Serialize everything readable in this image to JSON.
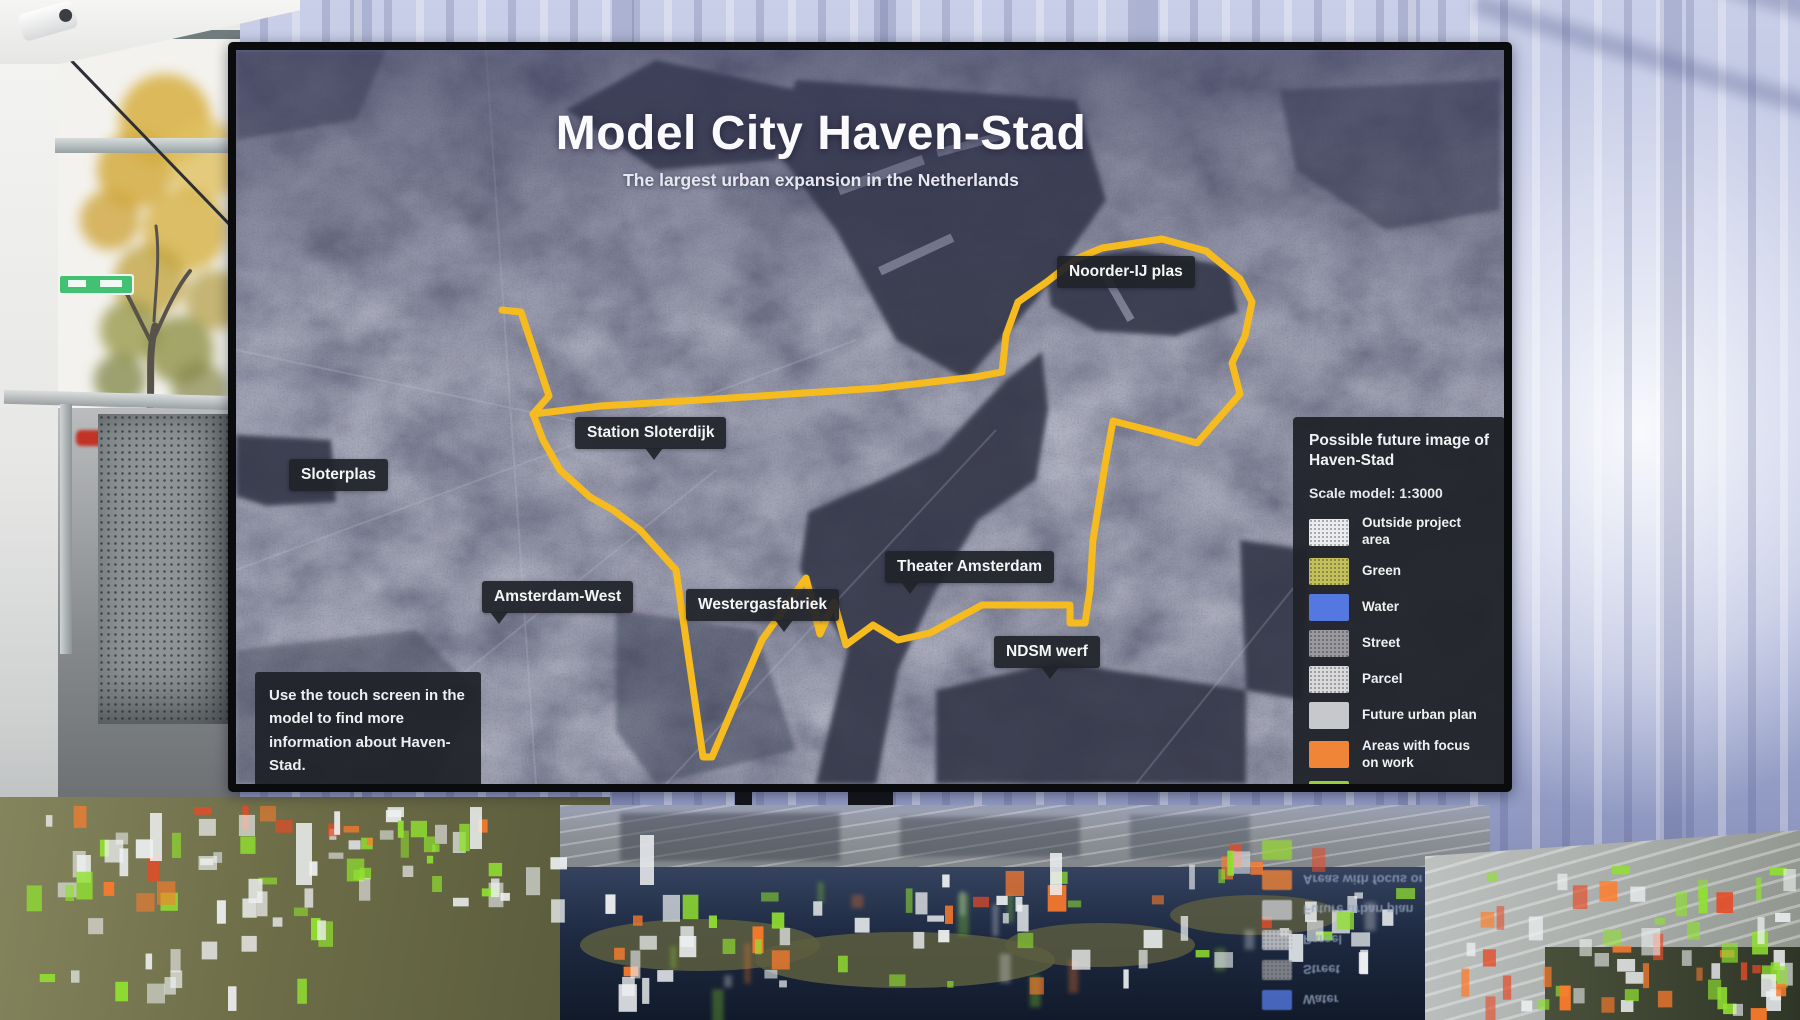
{
  "screen": {
    "title": "Model City Haven-Stad",
    "subtitle": "The largest urban expansion in the Netherlands",
    "map_labels": {
      "noorder_ij_plas": "Noorder-IJ plas",
      "station_sloterdijk": "Station Sloterdijk",
      "sloterplas": "Sloterplas",
      "amsterdam_west": "Amsterdam-West",
      "westergasfabriek": "Westergasfabriek",
      "theater_amsterdam": "Theater Amsterdam",
      "ndsm_werf": "NDSM werf"
    },
    "legend": {
      "title": "Possible future image of Haven-Stad",
      "scale_note": "Scale model: 1:3000",
      "items": [
        {
          "label": "Outside project area",
          "color": "#e9ebee",
          "textured": true
        },
        {
          "label": "Green",
          "color": "#c2bf58",
          "textured": true
        },
        {
          "label": "Water",
          "color": "#5379e0",
          "textured": false
        },
        {
          "label": "Street",
          "color": "#97979d",
          "textured": true
        },
        {
          "label": "Parcel",
          "color": "#d8d9db",
          "textured": true
        },
        {
          "label": "Future urban plan",
          "color": "#c6c8cb",
          "textured": false
        },
        {
          "label": "Areas with focus on work",
          "color": "#f08437",
          "textured": false
        },
        {
          "label": "Vibrant city streets",
          "color": "#97d13a",
          "textured": false
        }
      ]
    },
    "info_box": "Use the touch screen in the model to find more information about Haven-Stad.",
    "colors": {
      "boundary": "#f6bb1f",
      "label_bg": "#24262c"
    }
  }
}
